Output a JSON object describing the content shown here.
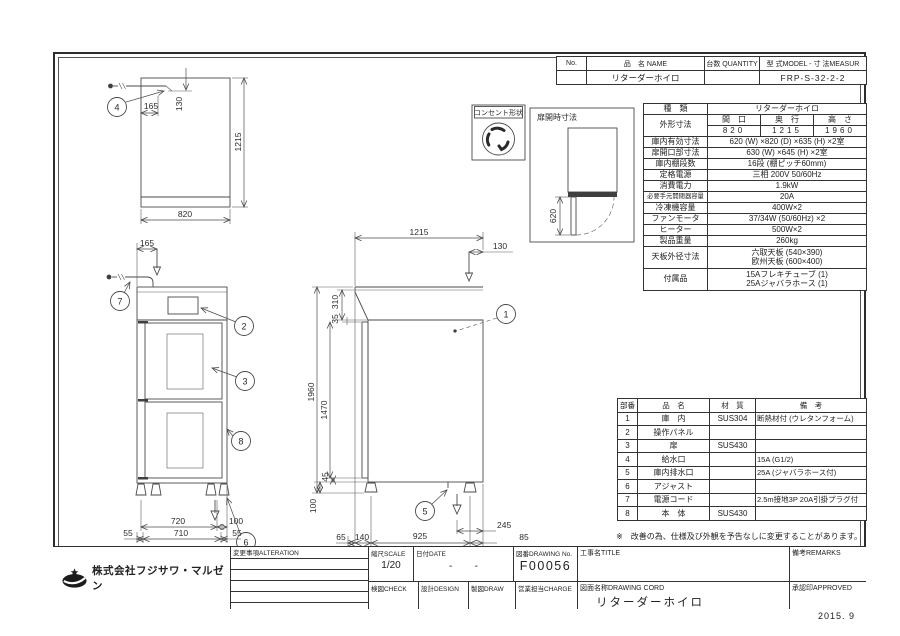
{
  "name_table": {
    "no_h": "No.",
    "name_h": "品　名 NAME",
    "qty_h": "台数 QUANTITY",
    "model_h": "型 式MODEL - 寸 法MEASUR",
    "name_v": "リターダーホイロ",
    "model_v": "FRP-S-32-2-2"
  },
  "spec": {
    "kind_label": "種　類",
    "kind_value": "リターダーホイロ",
    "outer_label": "外形寸法",
    "w_h": "間　口",
    "d_h": "奥　行",
    "h_h": "高　さ",
    "w": "820",
    "d": "1215",
    "h": "1960",
    "rows": [
      {
        "label": "庫内有効寸法",
        "value": "620 (W) ×820 (D) ×635 (H) ×2室"
      },
      {
        "label": "扉開口部寸法",
        "value": "630 (W) ×645 (H) ×2室"
      },
      {
        "label": "庫内棚段数",
        "value": "16段 (棚ピッチ60mm)"
      },
      {
        "label": "定格電源",
        "value": "三相  200V  50/60Hz"
      },
      {
        "label": "消費電力",
        "value": "1.9kW"
      },
      {
        "label": "必要手元開閉器容量",
        "value": "20A"
      },
      {
        "label": "冷凍機容量",
        "value": "400W×2"
      },
      {
        "label": "ファンモータ",
        "value": "37/34W (50/60Hz) ×2"
      },
      {
        "label": "ヒーター",
        "value": "500W×2"
      },
      {
        "label": "製品重量",
        "value": "260kg"
      }
    ],
    "tenban_label": "天板外径寸法",
    "tenban1": "六取天板 (540×390)",
    "tenban2": "欧州天板 (600×400)",
    "fuzoku_label": "付属品",
    "fuzoku1": "15Aフレキチューブ (1)",
    "fuzoku2": "25Aジャバラホース (1)"
  },
  "parts": {
    "h_no": "部番",
    "h_name": "品　名",
    "h_mat": "材　質",
    "h_rem": "備　考",
    "rows": [
      {
        "no": "1",
        "name": "庫　内",
        "mat": "SUS304",
        "rem": "断熱材付 (ウレタンフォーム)"
      },
      {
        "no": "2",
        "name": "操作パネル",
        "mat": "",
        "rem": ""
      },
      {
        "no": "3",
        "name": "扉",
        "mat": "SUS430",
        "rem": ""
      },
      {
        "no": "4",
        "name": "給水口",
        "mat": "",
        "rem": "15A (G1/2)"
      },
      {
        "no": "5",
        "name": "庫内排水口",
        "mat": "",
        "rem": "25A (ジャバラホース付)"
      },
      {
        "no": "6",
        "name": "アジャスト",
        "mat": "",
        "rem": ""
      },
      {
        "no": "7",
        "name": "電源コード",
        "mat": "",
        "rem": "2.5m接地3P  20A引掛プラグ付"
      },
      {
        "no": "8",
        "name": "本　体",
        "mat": "SUS430",
        "rem": ""
      }
    ]
  },
  "note": "※　改善の為、仕様及び外観を予告なしに変更することがあります。",
  "title_block": {
    "alteration": "変更事項ALTERATION",
    "scale_label": "縮尺SCALE",
    "scale_value": "1/20",
    "date_label": "日付DATE",
    "date_value": "-        -",
    "dwg_label": "図番DRAWING No.",
    "dwg_value": "F00056",
    "check": "検図CHECK",
    "design": "設計DESIGN",
    "draw": "製図DRAW",
    "charge": "営業担当CHARGE",
    "title_label": "工事名TITLE",
    "remarks": "備考REMARKS",
    "cord_label": "図面名称DRAWING  CORD",
    "cord_value": "リターダーホイロ",
    "approved": "承認印APPROVED",
    "company": "株式会社フジサワ・マルゼン",
    "issue": "2015. 9"
  },
  "annotations": {
    "outlet_label": "コンセント形状",
    "door_open_label": "扉開時寸法",
    "door_open_dim": "620"
  },
  "dims": {
    "plan_w": "820",
    "plan_d": "1215",
    "plan_x": "165",
    "plan_y": "130",
    "front_top": "165",
    "front_720": "720",
    "front_100": "100",
    "front_55l": "55",
    "front_710": "710",
    "front_55r": "55",
    "side_1215": "1215",
    "side_130": "130",
    "side_310": "310",
    "side_35": "35",
    "side_1960": "1960",
    "side_1470": "1470",
    "side_45": "45",
    "side_100": "100",
    "side_65": "65",
    "side_140": "140",
    "side_925": "925",
    "side_85": "85",
    "side_245": "245"
  },
  "balloons": {
    "b1": "1",
    "b2": "2",
    "b3": "3",
    "b4": "4",
    "b5": "5",
    "b6": "6",
    "b7": "7",
    "b8": "8"
  }
}
